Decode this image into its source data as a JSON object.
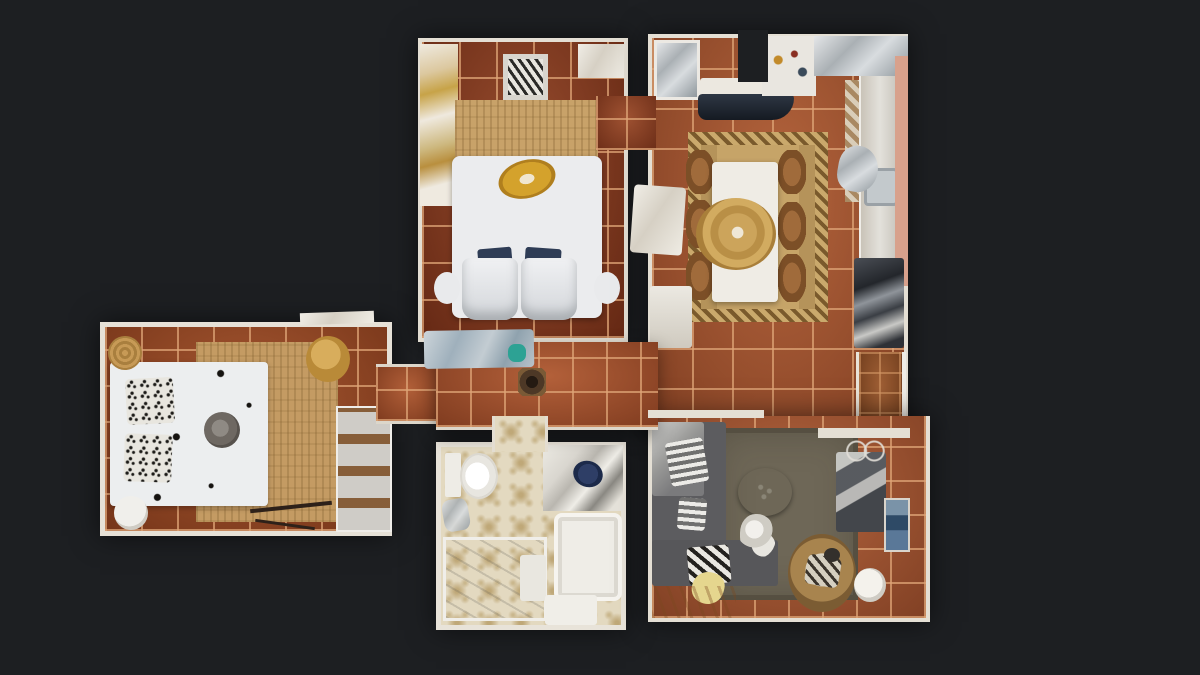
{
  "title": "Top-down 3D dollhouse floor plan of an apartment",
  "background": "#1d1f22",
  "rooms": {
    "bedroom_top": {
      "label": "Guest bedroom",
      "floor": "dark terracotta tile",
      "items": [
        "wardrobe with gold garments",
        "zebra-print bench",
        "tan area rug",
        "double bed with gold garment",
        "two navy pillows",
        "two white armchairs",
        "two nightstands"
      ]
    },
    "kitchen_dining": {
      "label": "Kitchen and dining room",
      "floor": "terracotta tile",
      "items": [
        "fridge",
        "kitchen counter with dark worktop",
        "upper cabinets with utensils",
        "mosaic backsplash",
        "sink counter",
        "chevron area rug",
        "white dining table",
        "wooden dining chairs",
        "gold pendant centerpiece",
        "silver chair",
        "sideboard with appliances",
        "pink wall",
        "balcony threshold"
      ]
    },
    "bedroom_left": {
      "label": "Master bedroom",
      "floor": "terracotta tile",
      "items": [
        "double bed",
        "printed pillows",
        "gray sun hat on bed",
        "jute rug",
        "wicker basket",
        "gold ottoman",
        "white stool",
        "ladder shelf",
        "bench"
      ]
    },
    "hallway": {
      "label": "Hallway",
      "floor": "terracotta tile",
      "items": [
        "console bench with blue-gray bags",
        "teal accent item",
        "round dark basket"
      ]
    },
    "bathroom": {
      "label": "Bathroom",
      "floor": "patterned encaustic tile",
      "items": [
        "toilet",
        "vanity with washbasin",
        "bathtub",
        "walk-in shower",
        "bath mat",
        "towel"
      ]
    },
    "living_room": {
      "label": "Living room",
      "floor": "terracotta tile",
      "items": [
        "gray corner sofa",
        "striped cushions",
        "yellow cushion",
        "olive area rug",
        "round wicker coffee table",
        "white flower decor",
        "round wicker armchair with striped cushion",
        "dark media bench",
        "wire wall decor",
        "wall niche with blue decor",
        "white floor lamp"
      ]
    }
  },
  "palette": {
    "background": "#1d1f22",
    "wall": "#e4dfd4",
    "tile_dark": "#82341a",
    "tile_mid": "#96431f",
    "tile_light": "#a5522e",
    "grout": "#d9a074",
    "rug_jute": "#c49b63",
    "rug_chevron": "#c6a468",
    "rug_living": "#6e6757",
    "bed_white": "#ecedee",
    "pillow_navy": "#2e3c55",
    "sofa_gray": "#5c5c5f",
    "bath_tile": "#e3d9c0",
    "bath_pattern": "#c6b184",
    "counter_dark": "#232a33",
    "pink_wall": "#d8a18c",
    "gold": "#c99a3f",
    "teal_accent": "#2da294"
  }
}
